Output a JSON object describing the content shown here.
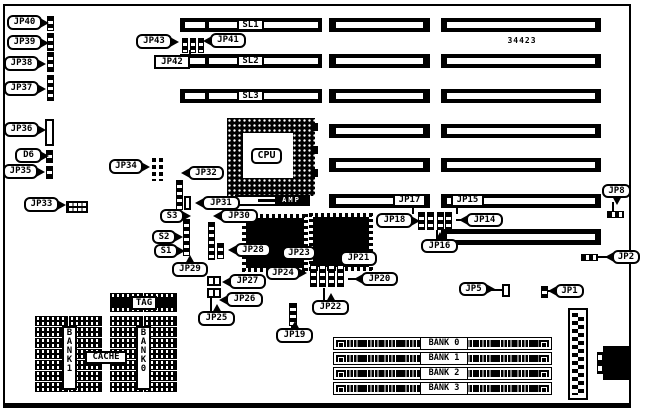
{
  "board": {
    "part_number": "34423"
  },
  "slots": {
    "labels": [
      "SL1",
      "SL2",
      "SL3"
    ]
  },
  "cpu": {
    "label": "CPU",
    "socket_brand": "AMP"
  },
  "memory": {
    "simm_banks": [
      "BANK 0",
      "BANK 1",
      "BANK 2",
      "BANK 3"
    ]
  },
  "cache": {
    "tag_label": "TAG",
    "cache_label": "CACHE",
    "bank_left_label": "BANK1",
    "bank_right_label": "BANK0"
  },
  "callouts": [
    {
      "text": "JP40",
      "x": 7,
      "y": 15,
      "w": 35,
      "h": 15,
      "shape": "rounded",
      "tail": "right"
    },
    {
      "text": "JP39",
      "x": 7,
      "y": 35,
      "w": 35,
      "h": 15,
      "shape": "rounded",
      "tail": "right"
    },
    {
      "text": "JP38",
      "x": 4,
      "y": 56,
      "w": 35,
      "h": 15,
      "shape": "rounded",
      "tail": "right"
    },
    {
      "text": "JP37",
      "x": 4,
      "y": 81,
      "w": 35,
      "h": 15,
      "shape": "rounded",
      "tail": "right"
    },
    {
      "text": "JP36",
      "x": 4,
      "y": 122,
      "w": 35,
      "h": 15,
      "shape": "rounded",
      "tail": "right"
    },
    {
      "text": "D6",
      "x": 15,
      "y": 148,
      "w": 27,
      "h": 15,
      "shape": "rounded",
      "tail": "right"
    },
    {
      "text": "JP35",
      "x": 3,
      "y": 164,
      "w": 35,
      "h": 15,
      "shape": "rounded",
      "tail": "right"
    },
    {
      "text": "JP33",
      "x": 24,
      "y": 197,
      "w": 35,
      "h": 15,
      "shape": "rounded",
      "tail": "right"
    },
    {
      "text": "JP34",
      "x": 109,
      "y": 159,
      "w": 34,
      "h": 15,
      "shape": "rounded",
      "tail": "right"
    },
    {
      "text": "JP43",
      "x": 136,
      "y": 34,
      "w": 36,
      "h": 15,
      "shape": "rounded",
      "tail": "right"
    },
    {
      "text": "JP41",
      "x": 210,
      "y": 33,
      "w": 36,
      "h": 15,
      "shape": "rounded",
      "tail": "left"
    },
    {
      "text": "JP42",
      "x": 154,
      "y": 55,
      "w": 36,
      "h": 14,
      "shape": "box",
      "line": [
        189,
        50,
        2,
        6
      ]
    },
    {
      "text": "JP32",
      "x": 188,
      "y": 166,
      "w": 36,
      "h": 14,
      "shape": "rounded",
      "tail": "left"
    },
    {
      "text": "JP31",
      "x": 202,
      "y": 196,
      "w": 38,
      "h": 14,
      "shape": "rounded",
      "tail": "left"
    },
    {
      "text": "JP30",
      "x": 220,
      "y": 209,
      "w": 38,
      "h": 14,
      "shape": "rounded",
      "tail": "left"
    },
    {
      "text": "S3",
      "x": 160,
      "y": 209,
      "w": 24,
      "h": 14,
      "shape": "rounded",
      "tail": "right"
    },
    {
      "text": "S2",
      "x": 152,
      "y": 230,
      "w": 24,
      "h": 14,
      "shape": "rounded",
      "tail": "right"
    },
    {
      "text": "S1",
      "x": 154,
      "y": 244,
      "w": 24,
      "h": 14,
      "shape": "rounded",
      "tail": "right"
    },
    {
      "text": "JP29",
      "x": 172,
      "y": 262,
      "w": 36,
      "h": 15,
      "shape": "rounded",
      "tail": "up"
    },
    {
      "text": "JP28",
      "x": 235,
      "y": 243,
      "w": 36,
      "h": 14,
      "shape": "rounded",
      "tail": "left"
    },
    {
      "text": "JP23",
      "x": 282,
      "y": 246,
      "w": 34,
      "h": 14,
      "shape": "rounded"
    },
    {
      "text": "JP24",
      "x": 266,
      "y": 266,
      "w": 34,
      "h": 14,
      "shape": "rounded",
      "tail": "right"
    },
    {
      "text": "JP27",
      "x": 229,
      "y": 274,
      "w": 37,
      "h": 15,
      "shape": "rounded",
      "tail": "left"
    },
    {
      "text": "JP26",
      "x": 226,
      "y": 292,
      "w": 37,
      "h": 15,
      "shape": "rounded",
      "tail": "left"
    },
    {
      "text": "JP25",
      "x": 198,
      "y": 311,
      "w": 37,
      "h": 15,
      "shape": "rounded",
      "tail": "up",
      "line": [
        210,
        297,
        2,
        14
      ]
    },
    {
      "text": "JP22",
      "x": 312,
      "y": 300,
      "w": 37,
      "h": 15,
      "shape": "rounded",
      "tail": "up",
      "line": [
        323,
        288,
        2,
        12
      ]
    },
    {
      "text": "JP21",
      "x": 340,
      "y": 251,
      "w": 37,
      "h": 15,
      "shape": "rounded",
      "tail": "up"
    },
    {
      "text": "JP20",
      "x": 361,
      "y": 272,
      "w": 37,
      "h": 14,
      "shape": "rounded",
      "tail": "left",
      "line": [
        348,
        278,
        13,
        2
      ]
    },
    {
      "text": "JP19",
      "x": 276,
      "y": 328,
      "w": 37,
      "h": 15,
      "shape": "rounded",
      "tail": "up",
      "line": [
        291,
        325,
        2,
        3
      ]
    },
    {
      "text": "JP18",
      "x": 376,
      "y": 213,
      "w": 37,
      "h": 15,
      "shape": "rounded",
      "tail": "right"
    },
    {
      "text": "JP14",
      "x": 466,
      "y": 213,
      "w": 37,
      "h": 14,
      "shape": "rounded",
      "tail": "left",
      "line": [
        456,
        219,
        10,
        2
      ]
    },
    {
      "text": "JP16",
      "x": 421,
      "y": 239,
      "w": 37,
      "h": 14,
      "shape": "rounded",
      "tail": "up",
      "line": [
        436,
        230,
        2,
        9
      ]
    },
    {
      "text": "JP17",
      "x": 393,
      "y": 194,
      "w": 33,
      "h": 13,
      "shape": "box",
      "line": [
        412,
        207,
        2,
        7
      ]
    },
    {
      "text": "JP15",
      "x": 451,
      "y": 194,
      "w": 33,
      "h": 13,
      "shape": "box",
      "line": [
        456,
        207,
        2,
        7
      ]
    },
    {
      "text": "JP8",
      "x": 602,
      "y": 184,
      "w": 29,
      "h": 14,
      "shape": "rounded",
      "tail": "down",
      "line": [
        612,
        202,
        2,
        9
      ]
    },
    {
      "text": "JP2",
      "x": 612,
      "y": 250,
      "w": 28,
      "h": 14,
      "shape": "rounded",
      "tail": "left",
      "line": [
        598,
        256,
        14,
        2
      ]
    },
    {
      "text": "JP5",
      "x": 459,
      "y": 282,
      "w": 29,
      "h": 14,
      "shape": "rounded",
      "tail": "right",
      "line": [
        490,
        289,
        13,
        2
      ]
    },
    {
      "text": "JP1",
      "x": 555,
      "y": 284,
      "w": 29,
      "h": 14,
      "shape": "rounded",
      "tail": "left",
      "line": [
        547,
        290,
        8,
        2
      ]
    }
  ]
}
